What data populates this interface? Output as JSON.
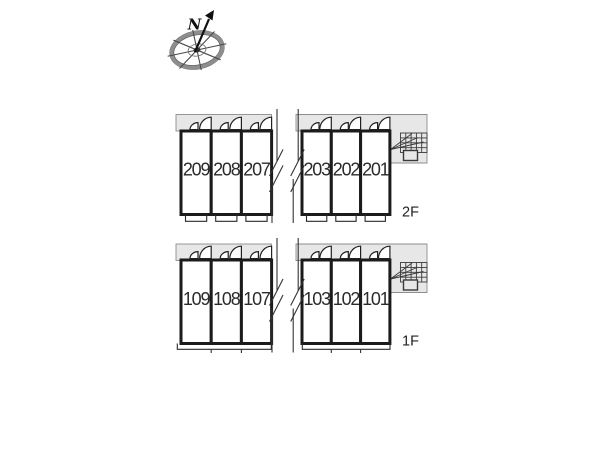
{
  "compass": {
    "north_label": "N"
  },
  "building": {
    "floors": [
      {
        "label": "2F",
        "left_rooms": [
          "209",
          "208",
          "207"
        ],
        "right_rooms": [
          "203",
          "202",
          "201"
        ]
      },
      {
        "label": "1F",
        "left_rooms": [
          "109",
          "108",
          "107"
        ],
        "right_rooms": [
          "103",
          "102",
          "101"
        ]
      }
    ]
  },
  "colors": {
    "background": "#ffffff",
    "wall": "#1b1b1b",
    "corridor_fill": "#e7e7e7",
    "corridor_border": "#8d8d8d",
    "room_number_text": "#2b2b2b",
    "line_work": "#333333"
  }
}
